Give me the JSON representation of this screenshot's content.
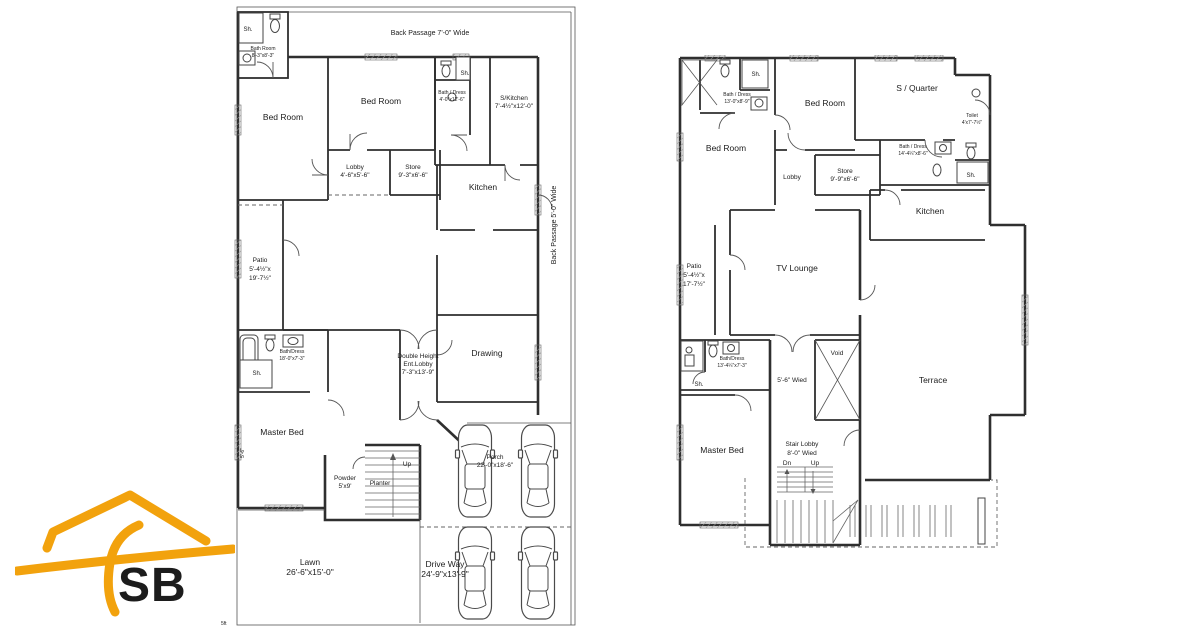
{
  "logo": {
    "text": "SB",
    "color": "#F2A20D"
  },
  "ground_floor": {
    "back_passage_top": "Back Passage 7'-0\" Wide",
    "back_passage_right": "Back Passage 5'-0\" Wide",
    "sh": "Sh.",
    "bath_room": "Bath Room",
    "bath_room_dims": "8'-3\"x8'-3\"",
    "bed_room": "Bed Room",
    "bath_dress": "Bath / Dress",
    "bath_dress_dims": "4'-0\"x12'-6\"",
    "s_kitchen": "S/Kitchen",
    "s_kitchen_dims": "7'-4½\"x12'-0\"",
    "lobby": "Lobby",
    "lobby_dims": "4'-6\"x5'-6\"",
    "store": "Store",
    "store_dims": "9'-3\"x6'-6\"",
    "kitchen": "Kitchen",
    "patio": "Patio",
    "patio_dims_1": "5'-4½\"x",
    "patio_dims_2": "19'-7½\"",
    "bath_dress_master": "Bath/Dress",
    "bath_dress_master_dims": "18'-0\"x7'-3\"",
    "ent_lobby_1": "Double Height",
    "ent_lobby_2": "Ent.Lobby",
    "ent_lobby_dims": "7'-3\"x13'-9\"",
    "drawing": "Drawing",
    "master_bed": "Master Bed",
    "powder": "Powder",
    "powder_dims": "5'x9'",
    "planter": "Planter",
    "up": "Up",
    "porch": "Porch",
    "porch_dims": "22'-0\"x18'-6\"",
    "lawn": "Lawn",
    "lawn_dims": "26'-6\"x15'-0\"",
    "drive_way": "Drive Way",
    "drive_way_dims": "24'-9\"x13'-9\"",
    "side_dim": "5'-6\"",
    "scale_mark": "5ft"
  },
  "first_floor": {
    "bath_dress_tl": "Bath / Dress",
    "bath_dress_tl_dims": "13'-0\"x8'-9\"",
    "sh": "Sh.",
    "bed_room": "Bed Room",
    "s_quarter": "S / Quarter",
    "toilet": "Toilet",
    "toilet_dims": "4'x7'-7½\"",
    "bath_dress_tr": "Bath / Dress",
    "bath_dress_tr_dims": "14'-4¼\"x8'-6\"",
    "lobby": "Lobby",
    "store": "Store",
    "store_dims": "9'-9\"x6'-6\"",
    "kitchen": "Kitchen",
    "patio": "Patio",
    "patio_dims_1": "5'-4½\"x",
    "patio_dims_2": "17'-7½\"",
    "tv_lounge": "TV Lounge",
    "bath_dress_m": "Bath/Dress",
    "bath_dress_m_dims": "13'-4¼\"x7'-3\"",
    "corridor": "5'-6\" Wied",
    "void": "Void",
    "terrace": "Terrace",
    "master_bed": "Master Bed",
    "stair_lobby": "Stair Lobby",
    "stair_lobby_dims": "8'-0\" Wied",
    "dn": "Dn",
    "up": "Up"
  }
}
